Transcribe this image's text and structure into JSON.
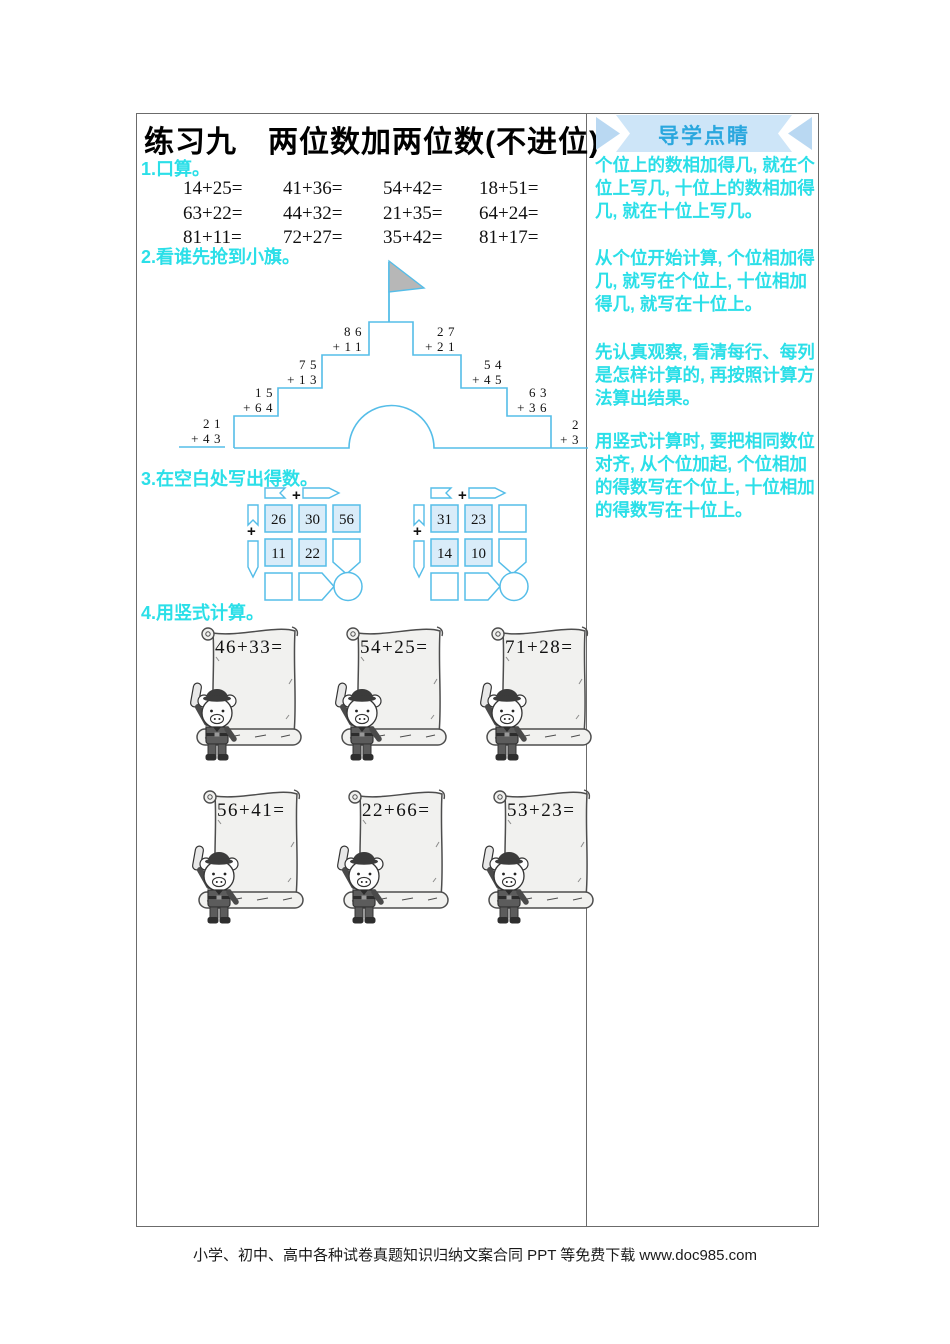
{
  "title": "练习九　两位数加两位数(不进位)",
  "sections": {
    "s1": "1.口算。",
    "s2": "2.看谁先抢到小旗。",
    "s3": "3.在空白处写出得数。",
    "s4": "4.用竖式计算。"
  },
  "oral": {
    "rows": [
      [
        "14+25=",
        "41+36=",
        "54+42=",
        "18+51="
      ],
      [
        "63+22=",
        "44+32=",
        "21+35=",
        "64+24="
      ],
      [
        "81+11=",
        "72+27=",
        "35+42=",
        "81+17="
      ]
    ]
  },
  "castle": {
    "problems": [
      {
        "top": "21",
        "bottom": "+43"
      },
      {
        "top": "15",
        "bottom": "+64"
      },
      {
        "top": "75",
        "bottom": "+13"
      },
      {
        "top": "86",
        "bottom": "+11"
      },
      {
        "top": "27",
        "bottom": "+21"
      },
      {
        "top": "54",
        "bottom": "+45"
      },
      {
        "top": "63",
        "bottom": "+36"
      },
      {
        "top": "2",
        "bottom": "+3"
      }
    ]
  },
  "grids": {
    "operator": "+",
    "first": {
      "cells": [
        [
          "26",
          "30",
          "56"
        ],
        [
          "11",
          "22",
          ""
        ],
        [
          "",
          "",
          ""
        ]
      ]
    },
    "second": {
      "cells": [
        [
          "31",
          "23",
          ""
        ],
        [
          "14",
          "10",
          ""
        ],
        [
          "",
          "",
          ""
        ]
      ]
    }
  },
  "scrolls": [
    "46+33=",
    "54+25=",
    "71+28=",
    "56+41=",
    "22+66=",
    "53+23="
  ],
  "sidebar": {
    "header": "导学点睛",
    "paragraphs": [
      "个位上的数相加得几, 就在个位上写几, 十位上的数相加得几, 就在十位上写几。",
      "从个位开始计算, 个位相加得几, 就写在个位上, 十位相加得几, 就写在十位上。",
      "先认真观察, 看清每行、每列是怎样计算的, 再按照计算方法算出结果。",
      "用竖式计算时, 要把相同数位对齐, 从个位加起, 个位相加的得数写在个位上, 十位相加的得数写在十位上。"
    ]
  },
  "footer": "小学、初中、高中各种试卷真题知识归纳文案合同 PPT 等免费下载 www.doc985.com",
  "colors": {
    "accent_cyan": "#2bdfe8",
    "banner_text": "#2aa7de",
    "banner_bg": "#cde5f8",
    "outline_blue": "#55bde8",
    "cell_fill": "#d9ecf9",
    "flag_gray": "#b7b7b7",
    "border": "#6b6b6b"
  }
}
